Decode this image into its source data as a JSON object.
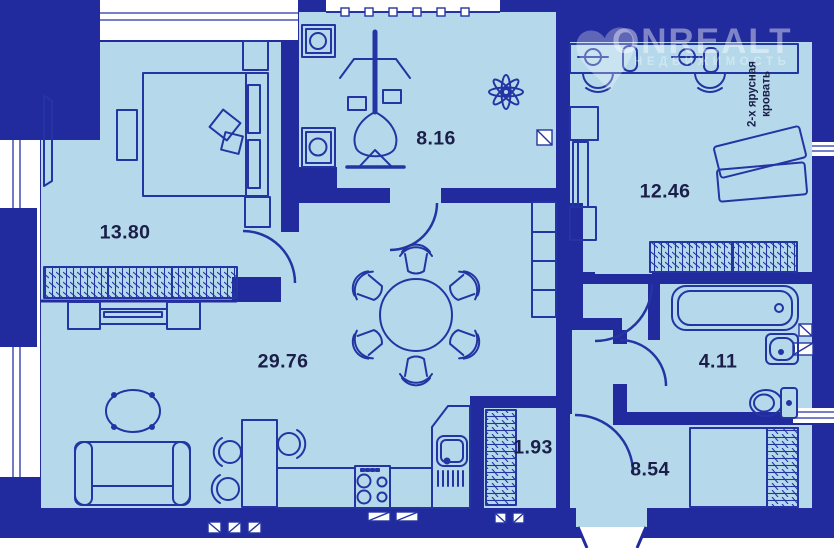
{
  "floor_plan": {
    "watermark": {
      "brand": "ONREALT",
      "tagline": "НЕДВИЖИМОСТЬ"
    },
    "rooms": [
      {
        "name": "bedroom",
        "area": "13.80"
      },
      {
        "name": "loggia-sport",
        "area": "8.16"
      },
      {
        "name": "kids-room",
        "area": "12.46",
        "annotation": "2-х ярусная кровать"
      },
      {
        "name": "living-room",
        "area": "29.76"
      },
      {
        "name": "bathroom",
        "area": "4.11"
      },
      {
        "name": "storage",
        "area": "1.93"
      },
      {
        "name": "hallway",
        "area": "8.54"
      }
    ],
    "colors": {
      "wall": "#222b9d",
      "floor": "#b5d9ea",
      "line": "#2435a3",
      "label": "#1a1e49"
    }
  }
}
